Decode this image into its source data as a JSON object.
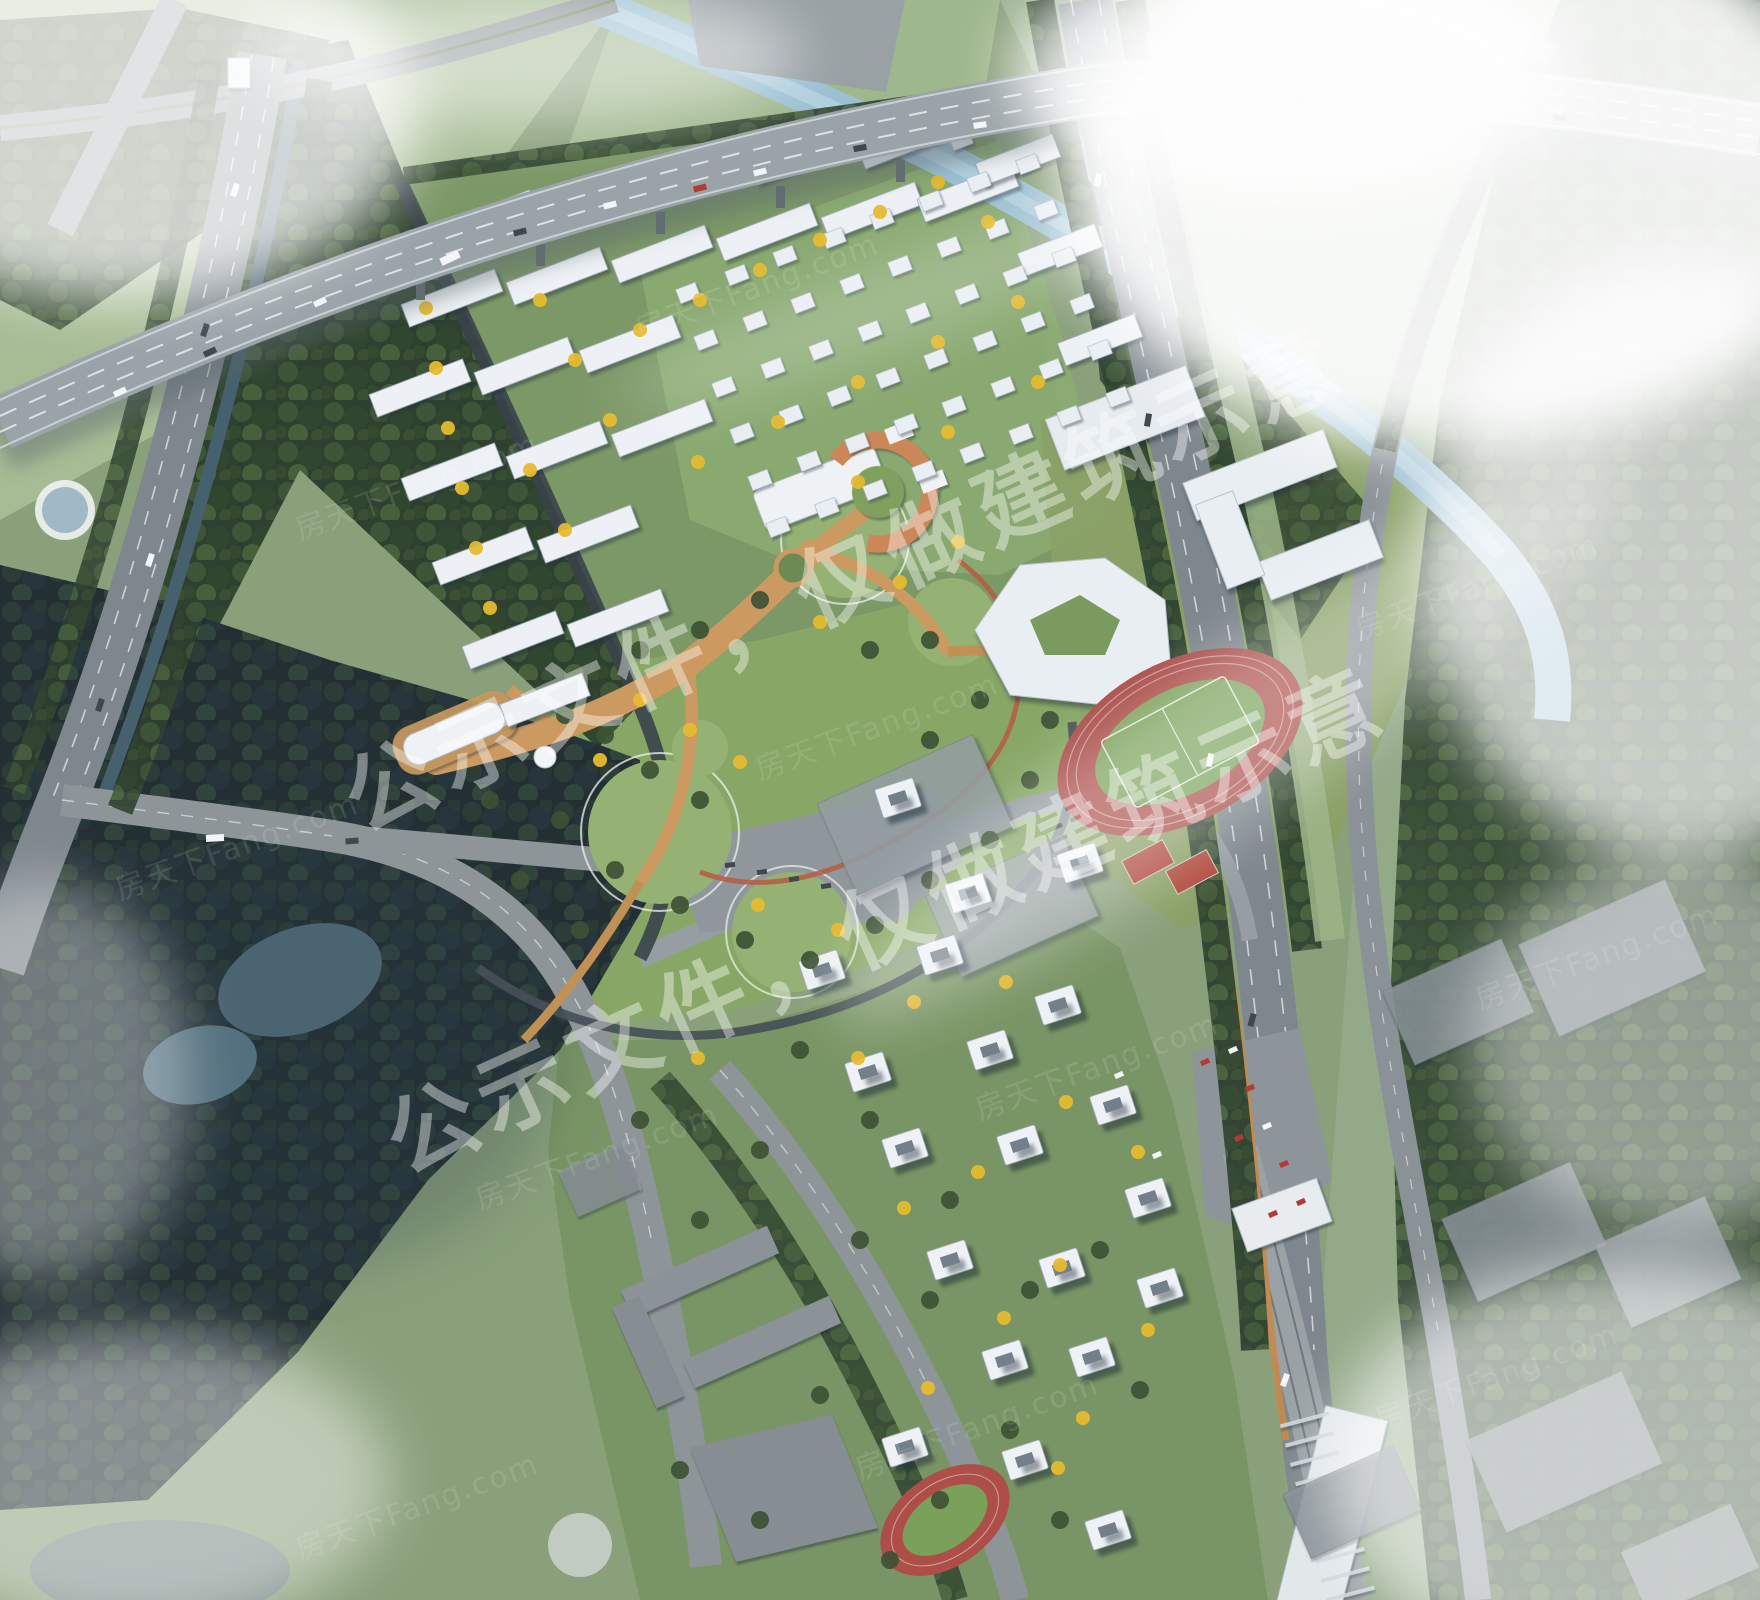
{
  "image": {
    "description": "Aerial bird's-eye architectural rendering of a residential masterplan with highway viaduct, central park, kindergarten, schools with running tracks, slab apartments, villa blocks and high-rise towers",
    "width": 1760,
    "height": 1600
  },
  "watermark": {
    "main_text": "公示文件，仅做建筑示意",
    "main_opacity": 0.4,
    "instances": [
      {
        "x": 858,
        "y": 608,
        "angle": -24.5,
        "font_size": 90
      },
      {
        "x": 900,
        "y": 950,
        "angle": -24.5,
        "font_size": 90
      }
    ],
    "brand_text": "房天下Fang.com",
    "brand_opacity": 0.11,
    "brand_font_size": 30,
    "brand_tiles": [
      [
        300,
        540,
        -20
      ],
      [
        640,
        340,
        -20
      ],
      [
        1120,
        210,
        -20
      ],
      [
        120,
        900,
        -20
      ],
      [
        760,
        780,
        -20
      ],
      [
        1360,
        640,
        -20
      ],
      [
        480,
        1210,
        -20
      ],
      [
        980,
        1120,
        -20
      ],
      [
        1480,
        1010,
        -20
      ],
      [
        300,
        1560,
        -20
      ],
      [
        860,
        1480,
        -20
      ],
      [
        1380,
        1430,
        -20
      ]
    ]
  },
  "palette": {
    "base_lawn": "#8aa07b",
    "field_light": "#a7bc95",
    "ground_north": "#7d9867",
    "ground_villa": "#8cab72",
    "park_lawn": "#88a766",
    "lawn_circle": "#95b173",
    "ground_south": "#7a9565",
    "forest_green": "#2e4030",
    "forest_dark": "#232f33",
    "water_river": "#9cc0d2",
    "water_pond": "#4b6472",
    "canal": "#46606d",
    "road_asphalt": "#7e878d",
    "viaduct_deck": "#9aa3a8",
    "lane_dash": "#f0f3f4",
    "path_orange": "#cc9a60",
    "jog_red": "#b65c42",
    "track_red": "#ab4f4b",
    "track_infield": "#7aa159",
    "roof_white": "#eef2f6",
    "roof_orange": "#cc8759",
    "massing_gray": "#939da2",
    "warehouse_gray": "#8e979c",
    "car_red": "#b23c34",
    "tree_yellow": "#e6bb2f",
    "tree_green": "#3d5134",
    "fog": "#ffffff"
  },
  "sprite_layers": [
    {
      "name": "north-slab-buildings",
      "group": "g-north-slabs",
      "item_name": "apartment-slab-building",
      "kind": "rect",
      "fill": "#edf1f5",
      "stroke": "#9fadb9",
      "stroke_width": 0.8,
      "w": 100,
      "h": 24,
      "rot": -21,
      "items": [
        [
          487,
          219
        ],
        [
          592,
          196
        ],
        [
          697,
          174
        ],
        [
          800,
          156
        ],
        [
          908,
          140
        ],
        [
          452,
          298
        ],
        [
          557,
          276
        ],
        [
          662,
          254
        ],
        [
          767,
          232
        ],
        [
          872,
          211
        ],
        [
          968,
          193
        ],
        [
          420,
          388
        ],
        [
          525,
          366
        ],
        [
          630,
          344
        ],
        [
          452,
          472
        ],
        [
          557,
          450
        ],
        [
          662,
          428
        ],
        [
          483,
          556
        ],
        [
          588,
          534
        ],
        [
          513,
          640
        ],
        [
          618,
          618
        ],
        [
          545,
          700,
          88
        ],
        [
          1018,
          160,
          82
        ],
        [
          1060,
          250,
          82
        ],
        [
          1100,
          340,
          82
        ]
      ]
    },
    {
      "name": "villa-blocks",
      "group": "g-villas",
      "item_name": "villa-building",
      "kind": "rect",
      "fill": "#e9eef3",
      "stroke": "#a9b5c0",
      "stroke_width": 0.6,
      "w": 21,
      "h": 15,
      "rot": -21,
      "items": [
        [
          760,
          480
        ],
        [
          809,
          461
        ],
        [
          857,
          443
        ],
        [
          906,
          424
        ],
        [
          954,
          406
        ],
        [
          1003,
          387
        ],
        [
          1051,
          369
        ],
        [
          1100,
          350
        ],
        [
          742,
          433
        ],
        [
          791,
          415
        ],
        [
          839,
          396
        ],
        [
          888,
          378
        ],
        [
          936,
          359
        ],
        [
          985,
          341
        ],
        [
          1033,
          322
        ],
        [
          1082,
          304
        ],
        [
          724,
          387
        ],
        [
          773,
          368
        ],
        [
          821,
          350
        ],
        [
          870,
          331
        ],
        [
          918,
          313
        ],
        [
          967,
          294
        ],
        [
          1015,
          276
        ],
        [
          1064,
          257
        ],
        [
          706,
          340
        ],
        [
          755,
          321
        ],
        [
          803,
          303
        ],
        [
          852,
          284
        ],
        [
          900,
          266
        ],
        [
          949,
          247
        ],
        [
          997,
          229
        ],
        [
          1046,
          210
        ],
        [
          688,
          293
        ],
        [
          737,
          275
        ],
        [
          785,
          256
        ],
        [
          834,
          238
        ],
        [
          882,
          219
        ],
        [
          931,
          201
        ],
        [
          979,
          182
        ],
        [
          1028,
          164
        ],
        [
          961,
          140
        ],
        [
          778,
          527
        ],
        [
          827,
          508
        ],
        [
          875,
          490
        ],
        [
          924,
          471
        ],
        [
          972,
          453
        ],
        [
          1021,
          434
        ],
        [
          1069,
          416
        ],
        [
          1118,
          397
        ]
      ]
    },
    {
      "name": "south-towers",
      "group": "g-towers",
      "item_name": "highrise-tower",
      "kind": "rect",
      "fill": "#eef2f6",
      "stroke": "#98a6b2",
      "stroke_width": 0.8,
      "w": 40,
      "h": 30,
      "rot": -18,
      "rx": 2,
      "inner": {
        "w": 18,
        "h": 11,
        "fill": "#5e6c78",
        "opacity": 0.85
      },
      "items": [
        [
          898,
          798
        ],
        [
          968,
          893
        ],
        [
          1080,
          863
        ],
        [
          822,
          970
        ],
        [
          940,
          955
        ],
        [
          1058,
          1005
        ],
        [
          868,
          1072
        ],
        [
          990,
          1050
        ],
        [
          1113,
          1105
        ],
        [
          905,
          1148
        ],
        [
          1020,
          1145
        ],
        [
          1148,
          1198
        ],
        [
          950,
          1260
        ],
        [
          1062,
          1268
        ],
        [
          1160,
          1288
        ],
        [
          1005,
          1360
        ],
        [
          1092,
          1357
        ],
        [
          905,
          1447
        ],
        [
          1025,
          1460
        ],
        [
          1108,
          1530
        ]
      ]
    },
    {
      "name": "yellow-trees",
      "group": "g-ytrees",
      "item_name": "ginkgo-tree",
      "kind": "circle",
      "fill": "#e6bb2f",
      "opacity": 0.95,
      "r": 7,
      "items": [
        [
          416,
          248
        ],
        [
          426,
          308
        ],
        [
          436,
          368
        ],
        [
          448,
          428
        ],
        [
          462,
          488
        ],
        [
          476,
          548
        ],
        [
          490,
          608
        ],
        [
          540,
          300
        ],
        [
          575,
          360
        ],
        [
          610,
          420
        ],
        [
          530,
          470
        ],
        [
          565,
          530
        ],
        [
          640,
          330
        ],
        [
          700,
          300
        ],
        [
          760,
          270
        ],
        [
          820,
          240
        ],
        [
          880,
          212
        ],
        [
          938,
          182
        ],
        [
          988,
          222
        ],
        [
          1018,
          302
        ],
        [
          938,
          342
        ],
        [
          858,
          382
        ],
        [
          778,
          422
        ],
        [
          698,
          462
        ],
        [
          858,
          482
        ],
        [
          948,
          432
        ],
        [
          1038,
          382
        ],
        [
          640,
          700
        ],
        [
          690,
          730
        ],
        [
          740,
          762
        ],
        [
          600,
          760
        ],
        [
          820,
          622
        ],
        [
          900,
          582
        ],
        [
          958,
          542
        ],
        [
          758,
          905
        ],
        [
          838,
          930
        ],
        [
          914,
          1002
        ],
        [
          1006,
          982
        ],
        [
          1066,
          1102
        ],
        [
          1138,
          1152
        ],
        [
          978,
          1172
        ],
        [
          904,
          1208
        ],
        [
          1060,
          1265
        ],
        [
          1148,
          1330
        ],
        [
          1004,
          1318
        ],
        [
          928,
          1388
        ],
        [
          1083,
          1418
        ],
        [
          1058,
          1468
        ],
        [
          858,
          1058
        ],
        [
          698,
          1058
        ]
      ]
    },
    {
      "name": "green-trees",
      "group": "g-gtrees",
      "item_name": "tree",
      "kind": "circle",
      "fill": "#3d5134",
      "opacity": 0.92,
      "r": 9,
      "items": [
        [
          565,
          715
        ],
        [
          605,
          735
        ],
        [
          650,
          770
        ],
        [
          700,
          800
        ],
        [
          560,
          820
        ],
        [
          615,
          870
        ],
        [
          680,
          905
        ],
        [
          745,
          940
        ],
        [
          810,
          960
        ],
        [
          875,
          925
        ],
        [
          930,
          880
        ],
        [
          990,
          840
        ],
        [
          1030,
          780
        ],
        [
          1050,
          720
        ],
        [
          980,
          700
        ],
        [
          930,
          740
        ],
        [
          580,
          930
        ],
        [
          520,
          880
        ],
        [
          490,
          800
        ],
        [
          870,
          650
        ],
        [
          930,
          640
        ],
        [
          760,
          600
        ],
        [
          700,
          630
        ],
        [
          640,
          650
        ],
        [
          800,
          1050
        ],
        [
          870,
          1120
        ],
        [
          950,
          1200
        ],
        [
          1030,
          1290
        ],
        [
          930,
          1300
        ],
        [
          860,
          1240
        ],
        [
          1100,
          1250
        ],
        [
          1140,
          1390
        ],
        [
          1010,
          1430
        ],
        [
          940,
          1500
        ],
        [
          1060,
          1520
        ],
        [
          760,
          1150
        ],
        [
          700,
          1220
        ],
        [
          640,
          1120
        ],
        [
          820,
          1395
        ],
        [
          890,
          1560
        ],
        [
          760,
          1520
        ],
        [
          680,
          1470
        ]
      ]
    },
    {
      "name": "cars-white",
      "group": "g-cars",
      "item_name": "car",
      "kind": "rect",
      "fill": "#f3f6f8",
      "w": 13,
      "h": 6,
      "items": [
        [
          120,
          392,
          null,
          null,
          -25
        ],
        [
          320,
          302,
          null,
          null,
          -25
        ],
        [
          610,
          205,
          null,
          null,
          -14
        ],
        [
          760,
          172,
          null,
          null,
          -14
        ],
        [
          980,
          125,
          null,
          null,
          -8
        ],
        [
          1200,
          103,
          null,
          null,
          -3
        ],
        [
          1420,
          108,
          null,
          null,
          2
        ],
        [
          450,
          258,
          20,
          8,
          -25
        ],
        [
          1098,
          180,
          null,
          null,
          -80
        ],
        [
          1210,
          760,
          null,
          null,
          -78
        ],
        [
          1285,
          1380,
          null,
          null,
          -70
        ],
        [
          235,
          190,
          null,
          null,
          -72
        ],
        [
          150,
          560,
          null,
          null,
          -72
        ],
        [
          215,
          838,
          18,
          7,
          -3
        ],
        [
          1119,
          1075,
          9,
          5,
          -24
        ],
        [
          1157,
          1155,
          9,
          5,
          -24
        ],
        [
          1233,
          1050,
          9,
          5,
          -24
        ],
        [
          1267,
          1126,
          9,
          5,
          -24
        ]
      ]
    },
    {
      "name": "cars-dark",
      "group": "g-cars",
      "item_name": "car",
      "kind": "rect",
      "fill": "#3f484e",
      "w": 13,
      "h": 6,
      "items": [
        [
          210,
          352,
          null,
          null,
          -25
        ],
        [
          520,
          232,
          null,
          null,
          -14
        ],
        [
          860,
          148,
          null,
          null,
          -10
        ],
        [
          1300,
          102,
          null,
          null,
          0
        ],
        [
          1560,
          118,
          null,
          null,
          3
        ],
        [
          1148,
          420,
          null,
          null,
          -80
        ],
        [
          1252,
          1020,
          null,
          null,
          -75
        ],
        [
          100,
          705,
          null,
          null,
          -72
        ],
        [
          205,
          330,
          null,
          null,
          -72
        ],
        [
          352,
          841,
          null,
          null,
          -4
        ],
        [
          730,
          865,
          10,
          5,
          -8
        ],
        [
          762,
          872,
          10,
          5,
          -8
        ],
        [
          794,
          879,
          10,
          5,
          -8
        ],
        [
          826,
          886,
          10,
          5,
          -8
        ]
      ]
    },
    {
      "name": "cars-red",
      "group": "g-cars",
      "item_name": "car",
      "kind": "rect",
      "fill": "#b23c34",
      "w": 13,
      "h": 6,
      "items": [
        [
          700,
          188,
          null,
          null,
          -14
        ],
        [
          1205,
          1062,
          9,
          5,
          -24
        ],
        [
          1239,
          1138,
          9,
          5,
          -24
        ],
        [
          1273,
          1214,
          9,
          5,
          -24
        ],
        [
          1250,
          1088,
          9,
          5,
          -24
        ],
        [
          1284,
          1164,
          9,
          5,
          -24
        ],
        [
          1301,
          1202,
          9,
          5,
          -24
        ]
      ]
    }
  ]
}
